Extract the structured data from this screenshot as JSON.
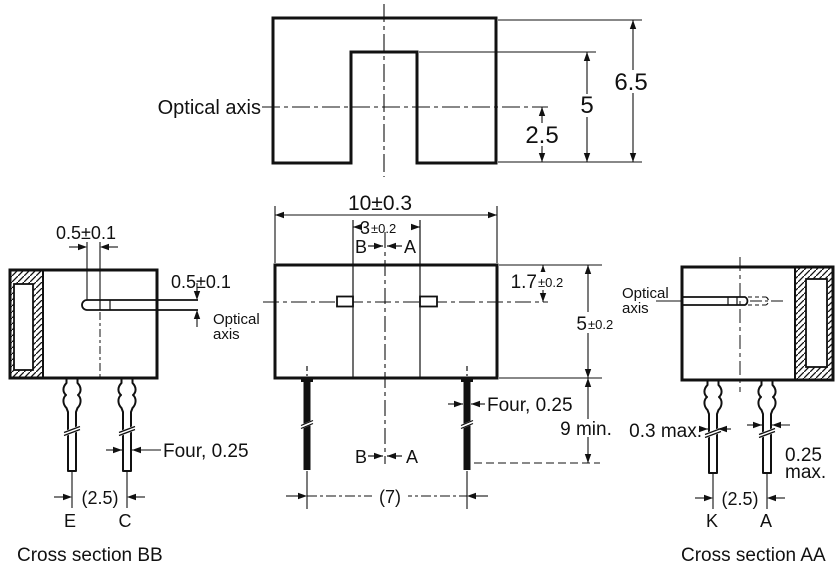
{
  "colors": {
    "ink": "#111111",
    "background": "#ffffff"
  },
  "top_view": {
    "optical_axis": "Optical axis",
    "dim_total_height": "6.5",
    "dim_slot_depth": "5",
    "dim_axis_offset": "2.5"
  },
  "front_view": {
    "dim_width": "10±0.3",
    "dim_gap": "3",
    "dim_gap_tol": "±0.2",
    "label_b_top": "B",
    "label_a_top": "A",
    "dim_axis_from_top": "1.7",
    "dim_axis_from_top_tol": "±0.2",
    "dim_height": "5",
    "dim_height_tol": "±0.2",
    "dim_lead_length": "9 min.",
    "dim_lead_width": "Four, 0.25",
    "dim_lead_pitch": "(7)",
    "label_b_bottom": "B",
    "label_a_bottom": "A"
  },
  "section_bb": {
    "dim_aperture_width": "0.5±0.1",
    "dim_aperture_height": "0.5±0.1",
    "optical_line1": "Optical",
    "optical_line2": "axis",
    "dim_lead_width": "Four, 0.25",
    "dim_lead_pitch": "(2.5)",
    "pin_left": "E",
    "pin_right": "C",
    "caption": "Cross section BB"
  },
  "section_aa": {
    "optical_line1": "Optical",
    "optical_line2": "axis",
    "dim_lead_thickness": "0.3 max.",
    "dim_lead_width_line1": "0.25",
    "dim_lead_width_line2": "max.",
    "dim_lead_pitch": "(2.5)",
    "pin_left": "K",
    "pin_right": "A",
    "caption": "Cross section AA"
  }
}
